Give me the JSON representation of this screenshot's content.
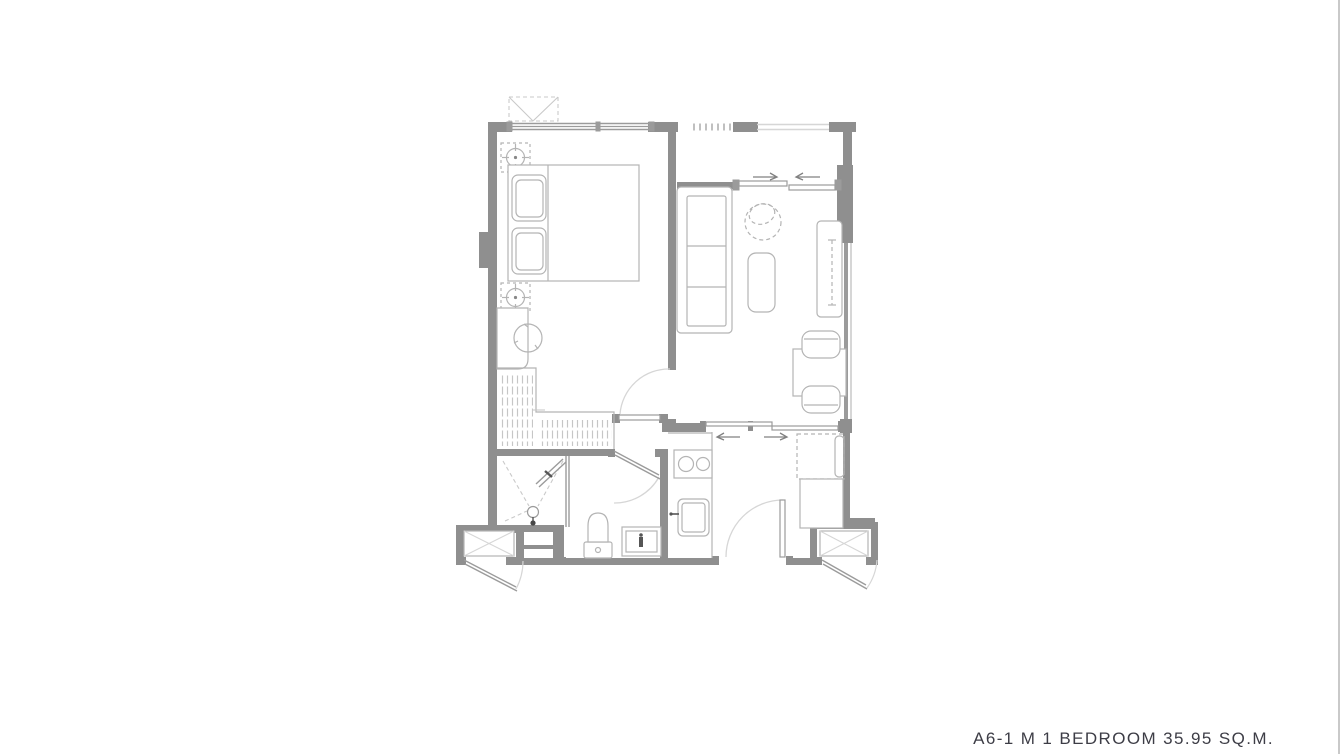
{
  "page": {
    "background": "#ffffff",
    "right_edge_color": "#c9c9c9"
  },
  "plan": {
    "title": "A6-1 M 1 BEDROOM 35.95 SQ.M.",
    "unit_code": "A6-1 M",
    "unit_type": "1 BEDROOM",
    "unit_area": "35.95 SQ.M.",
    "colors": {
      "wall": "#8f8f8f",
      "fixture_line": "#b4b4b4",
      "window_line": "#9b9b9b",
      "swing_arc": "#d6d6d6",
      "dashed_line": "#c9c9c9",
      "dark_accent": "#555555",
      "text": "#3d3d46"
    },
    "rooms": [
      {
        "name": "bedroom"
      },
      {
        "name": "living-room"
      },
      {
        "name": "balcony"
      },
      {
        "name": "bathroom"
      },
      {
        "name": "kitchen-entry"
      },
      {
        "name": "ac-ledge-left"
      },
      {
        "name": "ac-ledge-right"
      }
    ],
    "furniture": [
      "condenser-unit",
      "double-bed",
      "pillows",
      "ceiling-light",
      "dressing-desk",
      "dressing-stool",
      "wardrobe",
      "sofa",
      "lounge-chair",
      "coffee-table",
      "tv-console",
      "dining-table",
      "dining-chair",
      "refrigerator",
      "kitchen-counter",
      "cooktop",
      "kitchen-sink",
      "shower",
      "floor-drain",
      "toilet",
      "washbasin",
      "sliding-door",
      "swing-door",
      "window",
      "louver-vent",
      "balcony-railing"
    ]
  }
}
